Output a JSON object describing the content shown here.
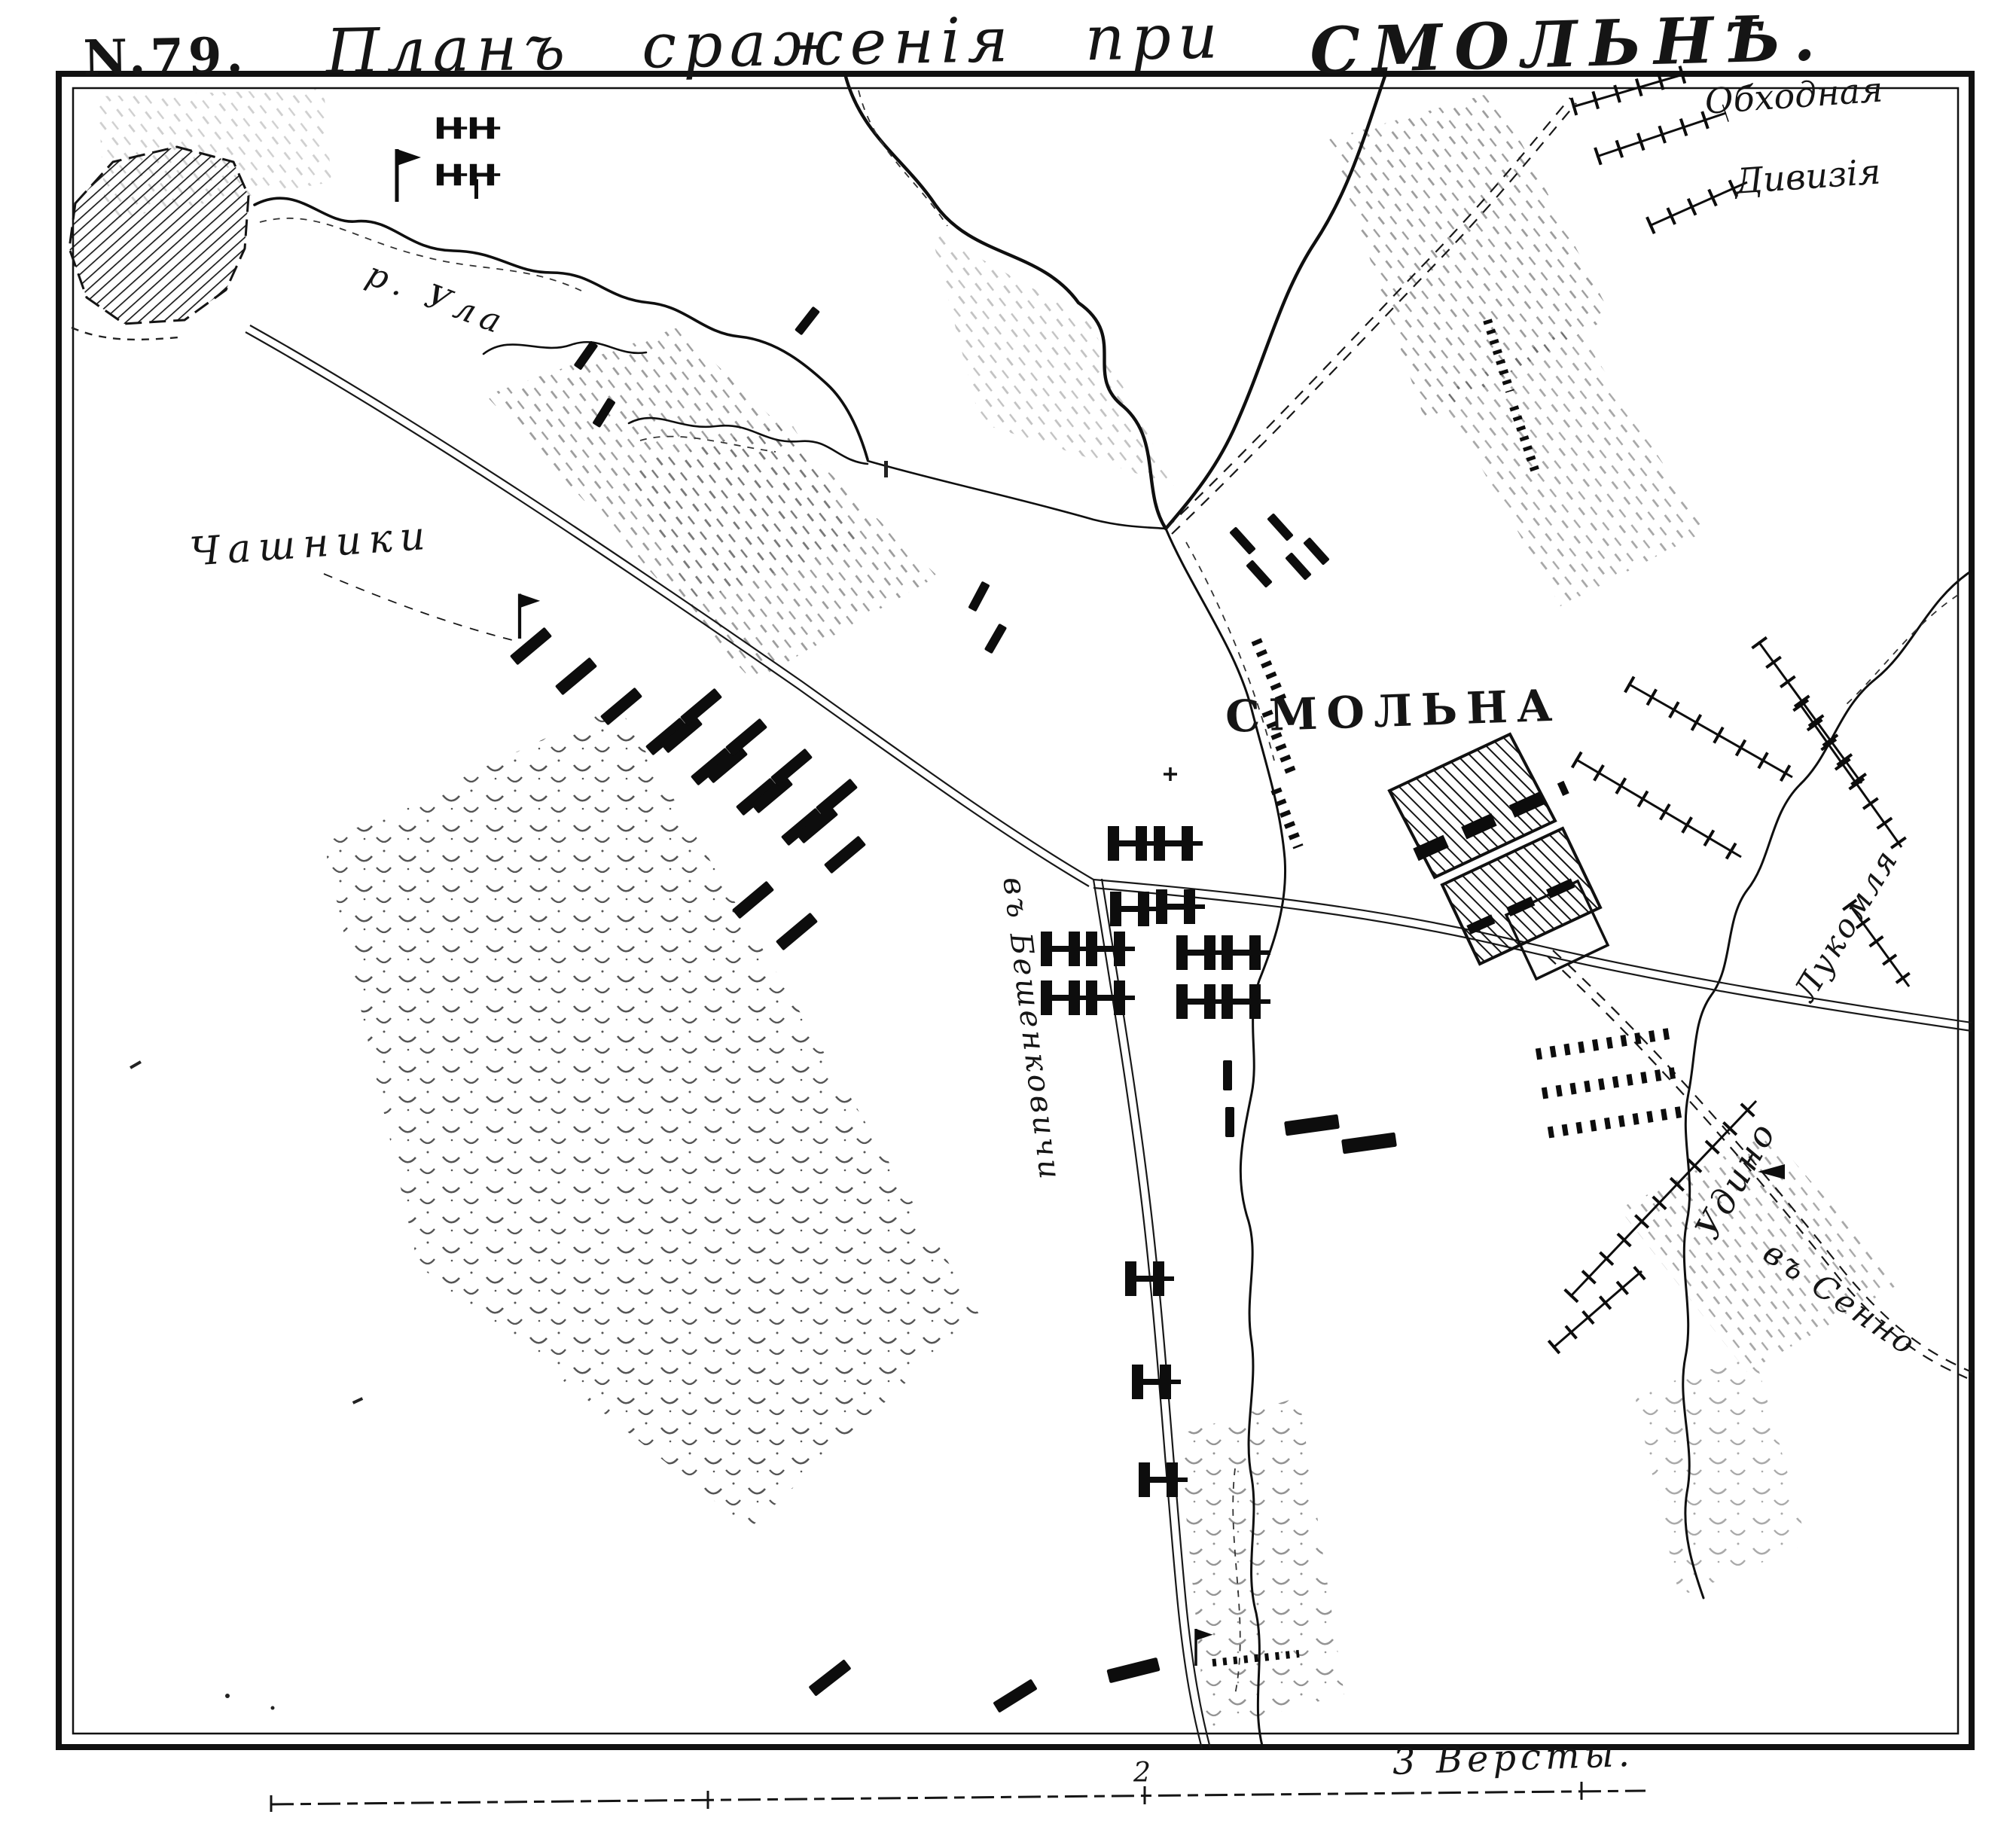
{
  "title": {
    "number": "N.79.",
    "battle": "Планъ сраженія при",
    "place": "СМОЛЬНѢ."
  },
  "labels": {
    "flank_div_1": "Обходная",
    "flank_div_2": "Дивизія",
    "chashniki": "Чашники",
    "river_ula": "р. Ула",
    "smolna": "СМОЛЬНА",
    "river_lukomlya": "Лукомля",
    "to_senno": "въ Сенно",
    "oudinot": "Удино",
    "to_beshenkovichi": "въ Бешенковичи"
  },
  "scale": {
    "mark": "2",
    "caption": "3 Версты."
  },
  "map": {
    "ink": "#151515",
    "paper": "#ffffff"
  }
}
